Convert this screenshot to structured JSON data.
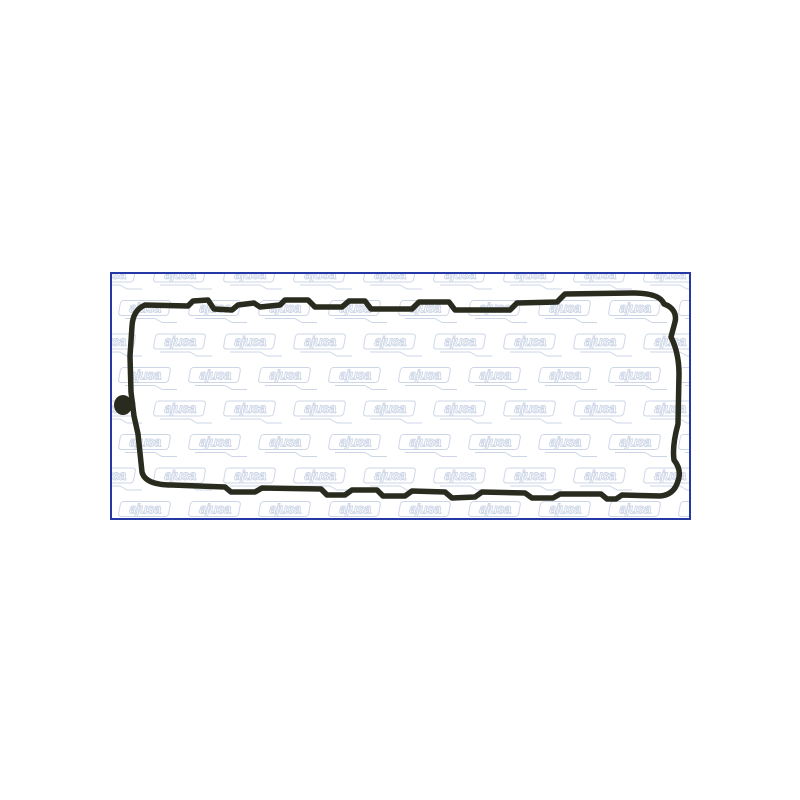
{
  "page": {
    "background_color": "#ffffff"
  },
  "product_image": {
    "frame_border_color": "#2438a6",
    "inner_background_color": "#ffffff",
    "watermark": {
      "text": "ajusa",
      "color": "#b9c6dd"
    },
    "gasket": {
      "stroke_color": "#292b1f",
      "part_kind": "valve-cover-gasket-outline"
    }
  }
}
